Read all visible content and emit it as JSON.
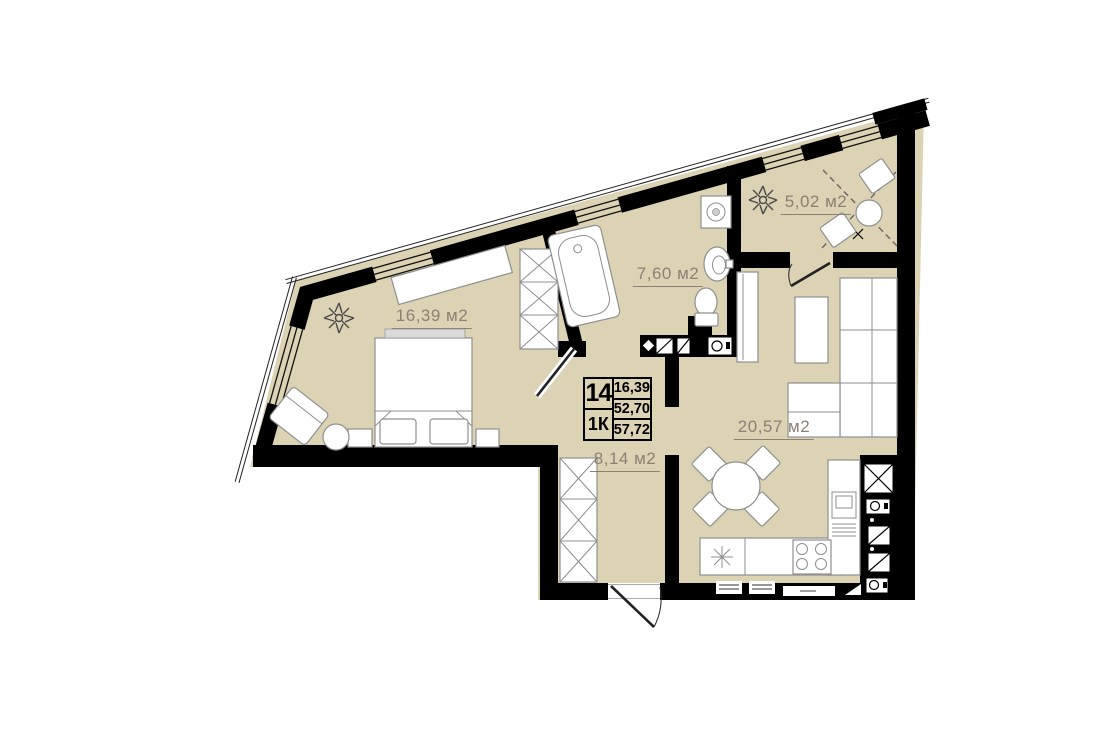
{
  "floorplan": {
    "info_box": {
      "unit_number": "14",
      "unit_type": "1К",
      "values": [
        "16,39",
        "52,70",
        "57,72"
      ]
    },
    "rooms": [
      {
        "name": "bedroom",
        "area_label": "16,39 м2"
      },
      {
        "name": "bathroom",
        "area_label": "7,60 м2"
      },
      {
        "name": "balcony",
        "area_label": "5,02 м2"
      },
      {
        "name": "living-kitchen",
        "area_label": "20,57 м2"
      },
      {
        "name": "hallway",
        "area_label": "8,14 м2"
      }
    ],
    "colors": {
      "floor": "#dcd2b4",
      "wall": "#000000",
      "area_text": "#8c8174",
      "furniture_stroke": "#8f8f8f"
    }
  }
}
